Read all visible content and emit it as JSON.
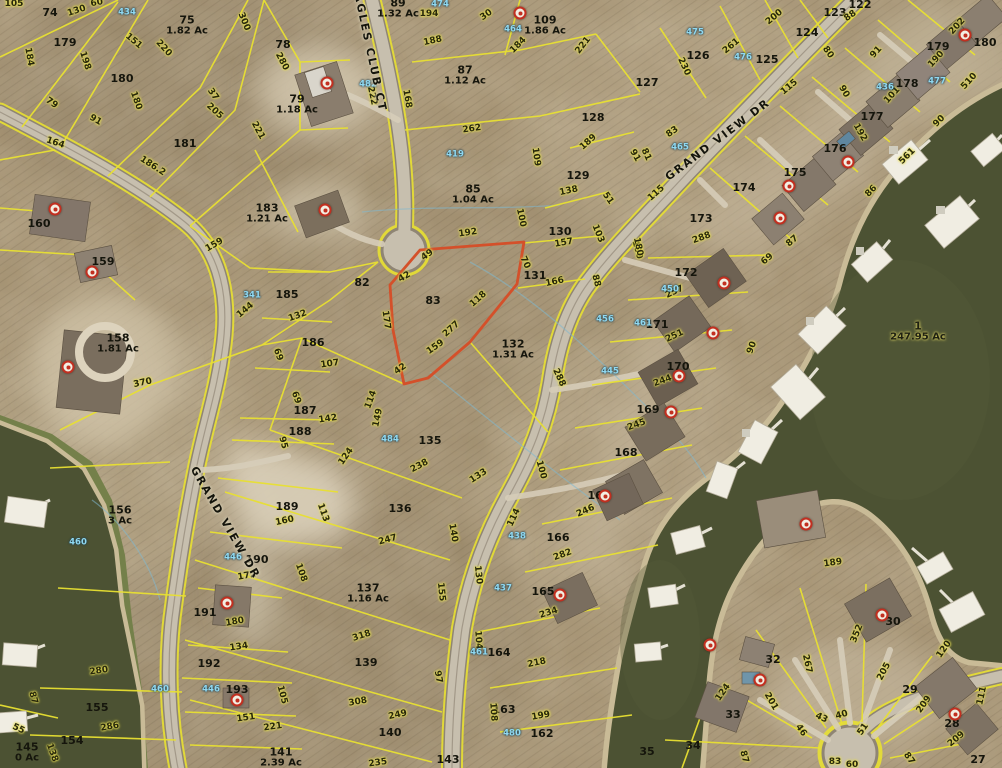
{
  "map": {
    "description": "aerial parcel map with lot boundaries and lake",
    "colors": {
      "parcel_line": "#e8e032",
      "highlight": "#d4502a",
      "water": "#4c5233",
      "blue_label": "#8fd9f2"
    },
    "streets": [
      {
        "name": "EAGLES CLUB CT",
        "x": 369,
        "y": 48,
        "rot": 78
      },
      {
        "name": "GRAND VIEW DR",
        "x": 718,
        "y": 140,
        "rot": -37
      },
      {
        "name": "GRAND VIEW DR",
        "x": 225,
        "y": 523,
        "rot": 60
      }
    ],
    "parcels": [
      {
        "id": "74",
        "x": 50,
        "y": 13
      },
      {
        "id": "179",
        "x": 65,
        "y": 43
      },
      {
        "id": "75",
        "ac": "1.82 Ac",
        "x": 187,
        "y": 26
      },
      {
        "id": "78",
        "x": 283,
        "y": 45
      },
      {
        "id": "180",
        "x": 122,
        "y": 79
      },
      {
        "id": "79",
        "ac": "1.18 Ac",
        "x": 297,
        "y": 105
      },
      {
        "id": "181",
        "x": 185,
        "y": 144
      },
      {
        "id": "160",
        "x": 39,
        "y": 224
      },
      {
        "id": "183",
        "ac": "1.21 Ac",
        "x": 267,
        "y": 214
      },
      {
        "id": "159",
        "x": 103,
        "y": 262
      },
      {
        "id": "158",
        "ac": "1.81 Ac",
        "x": 118,
        "y": 344
      },
      {
        "id": "185",
        "x": 287,
        "y": 295
      },
      {
        "id": "186",
        "x": 313,
        "y": 343
      },
      {
        "id": "187",
        "x": 305,
        "y": 411
      },
      {
        "id": "188",
        "x": 300,
        "y": 432
      },
      {
        "id": "156",
        "ac": "3 Ac",
        "x": 120,
        "y": 516
      },
      {
        "id": "189",
        "x": 287,
        "y": 507
      },
      {
        "id": "190",
        "x": 257,
        "y": 560
      },
      {
        "id": "191",
        "x": 205,
        "y": 613
      },
      {
        "id": "192",
        "x": 209,
        "y": 664
      },
      {
        "id": "193",
        "x": 237,
        "y": 690
      },
      {
        "id": "155",
        "x": 97,
        "y": 708
      },
      {
        "id": "154",
        "x": 72,
        "y": 741
      },
      {
        "id": "145",
        "ac": "0 Ac",
        "x": 27,
        "y": 753
      },
      {
        "id": "141",
        "ac": "2.39 Ac",
        "x": 281,
        "y": 758
      },
      {
        "id": "89",
        "ac": "1.32 Ac",
        "x": 398,
        "y": 9
      },
      {
        "id": "109",
        "ac": "1.86 Ac",
        "x": 545,
        "y": 26
      },
      {
        "id": "87",
        "ac": "1.12 Ac",
        "x": 465,
        "y": 76
      },
      {
        "id": "85",
        "ac": "1.04 Ac",
        "x": 473,
        "y": 195
      },
      {
        "id": "83",
        "x": 433,
        "y": 301
      },
      {
        "id": "82",
        "x": 362,
        "y": 283
      },
      {
        "id": "128",
        "x": 593,
        "y": 118
      },
      {
        "id": "129",
        "x": 578,
        "y": 176
      },
      {
        "id": "130",
        "x": 560,
        "y": 232
      },
      {
        "id": "131",
        "x": 535,
        "y": 276
      },
      {
        "id": "132",
        "ac": "1.31 Ac",
        "x": 513,
        "y": 350
      },
      {
        "id": "135",
        "x": 430,
        "y": 441
      },
      {
        "id": "136",
        "x": 400,
        "y": 509
      },
      {
        "id": "137",
        "ac": "1.16 Ac",
        "x": 368,
        "y": 594
      },
      {
        "id": "139",
        "x": 366,
        "y": 663
      },
      {
        "id": "140",
        "x": 390,
        "y": 733
      },
      {
        "id": "143",
        "x": 448,
        "y": 760
      },
      {
        "id": "164",
        "x": 499,
        "y": 653
      },
      {
        "id": "163",
        "x": 504,
        "y": 710
      },
      {
        "id": "162",
        "x": 542,
        "y": 734
      },
      {
        "id": "165",
        "x": 543,
        "y": 592
      },
      {
        "id": "166",
        "x": 558,
        "y": 538
      },
      {
        "id": "167",
        "x": 599,
        "y": 496
      },
      {
        "id": "168",
        "x": 626,
        "y": 453
      },
      {
        "id": "169",
        "x": 648,
        "y": 410
      },
      {
        "id": "170",
        "x": 678,
        "y": 367
      },
      {
        "id": "171",
        "x": 657,
        "y": 325
      },
      {
        "id": "172",
        "x": 686,
        "y": 273
      },
      {
        "id": "173",
        "x": 701,
        "y": 219
      },
      {
        "id": "174",
        "x": 744,
        "y": 188
      },
      {
        "id": "175",
        "x": 795,
        "y": 173
      },
      {
        "id": "176",
        "x": 835,
        "y": 149
      },
      {
        "id": "177",
        "x": 872,
        "y": 117
      },
      {
        "id": "178",
        "x": 907,
        "y": 84
      },
      {
        "id": "179",
        "x": 938,
        "y": 47
      },
      {
        "id": "180",
        "x": 985,
        "y": 43
      },
      {
        "id": "122",
        "x": 860,
        "y": 5
      },
      {
        "id": "123",
        "x": 835,
        "y": 13
      },
      {
        "id": "124",
        "x": 807,
        "y": 33
      },
      {
        "id": "125",
        "x": 767,
        "y": 60
      },
      {
        "id": "126",
        "x": 698,
        "y": 56
      },
      {
        "id": "127",
        "x": 647,
        "y": 83
      },
      {
        "id": "35",
        "x": 647,
        "y": 752
      },
      {
        "id": "34",
        "x": 693,
        "y": 746
      },
      {
        "id": "33",
        "x": 733,
        "y": 715
      },
      {
        "id": "32",
        "x": 773,
        "y": 660
      },
      {
        "id": "30",
        "x": 893,
        "y": 622
      },
      {
        "id": "29",
        "x": 910,
        "y": 690
      },
      {
        "id": "28",
        "x": 952,
        "y": 724
      },
      {
        "id": "27",
        "x": 978,
        "y": 760
      },
      {
        "id": "1",
        "ac": "247.95 Ac",
        "x": 918,
        "y": 332,
        "water": true
      }
    ],
    "dimensions": [
      [
        "105",
        14,
        5,
        0
      ],
      [
        "130",
        77,
        12,
        -18
      ],
      [
        "60",
        97,
        4,
        -10
      ],
      [
        "300",
        243,
        22,
        68
      ],
      [
        "220",
        163,
        49,
        47
      ],
      [
        "151",
        133,
        42,
        40
      ],
      [
        "184",
        28,
        57,
        80
      ],
      [
        "198",
        84,
        61,
        72
      ],
      [
        "79",
        51,
        104,
        35
      ],
      [
        "91",
        95,
        121,
        30
      ],
      [
        "164",
        55,
        144,
        18
      ],
      [
        "186.2",
        152,
        167,
        33
      ],
      [
        "180",
        135,
        101,
        70
      ],
      [
        "205",
        214,
        112,
        42
      ],
      [
        "221",
        257,
        131,
        62
      ],
      [
        "37",
        212,
        95,
        55
      ],
      [
        "280",
        281,
        62,
        62
      ],
      [
        "222",
        371,
        96,
        78
      ],
      [
        "168",
        406,
        99,
        80
      ],
      [
        "188",
        433,
        42,
        -12
      ],
      [
        "194",
        429,
        15,
        0
      ],
      [
        "30",
        487,
        16,
        -35
      ],
      [
        "184",
        519,
        46,
        -45
      ],
      [
        "221",
        584,
        46,
        -52
      ],
      [
        "262",
        472,
        130,
        -8
      ],
      [
        "109",
        535,
        157,
        82
      ],
      [
        "189",
        589,
        143,
        -42
      ],
      [
        "91",
        634,
        156,
        60
      ],
      [
        "115",
        657,
        194,
        -42
      ],
      [
        "138",
        569,
        192,
        -12
      ],
      [
        "51",
        607,
        199,
        55
      ],
      [
        "100",
        520,
        218,
        78
      ],
      [
        "103",
        597,
        234,
        68
      ],
      [
        "100",
        636,
        250,
        75
      ],
      [
        "157",
        564,
        244,
        -10
      ],
      [
        "70",
        524,
        263,
        65
      ],
      [
        "88",
        595,
        281,
        75
      ],
      [
        "166",
        555,
        283,
        -12
      ],
      [
        "192",
        468,
        234,
        -8
      ],
      [
        "49",
        428,
        256,
        -35
      ],
      [
        "42",
        405,
        278,
        -30
      ],
      [
        "42",
        401,
        370,
        -35
      ],
      [
        "177",
        385,
        320,
        82
      ],
      [
        "118",
        479,
        300,
        -42
      ],
      [
        "277",
        452,
        330,
        -42
      ],
      [
        "159",
        436,
        348,
        -35
      ],
      [
        "288",
        558,
        378,
        65
      ],
      [
        "159",
        215,
        246,
        -30
      ],
      [
        "144",
        246,
        311,
        -40
      ],
      [
        "132",
        298,
        317,
        -20
      ],
      [
        "370",
        143,
        384,
        -12
      ],
      [
        "69",
        277,
        355,
        70
      ],
      [
        "107",
        330,
        365,
        -8
      ],
      [
        "69",
        295,
        398,
        70
      ],
      [
        "142",
        328,
        420,
        -8
      ],
      [
        "114",
        372,
        400,
        -70
      ],
      [
        "149",
        379,
        418,
        -78
      ],
      [
        "95",
        282,
        443,
        75
      ],
      [
        "124",
        347,
        457,
        -55
      ],
      [
        "238",
        420,
        467,
        -28
      ],
      [
        "133",
        479,
        477,
        -33
      ],
      [
        "100",
        540,
        470,
        75
      ],
      [
        "247",
        388,
        541,
        -15
      ],
      [
        "140",
        452,
        533,
        80
      ],
      [
        "114",
        515,
        518,
        -65
      ],
      [
        "155",
        440,
        592,
        84
      ],
      [
        "130",
        477,
        575,
        84
      ],
      [
        "104",
        477,
        640,
        86
      ],
      [
        "97",
        437,
        677,
        80
      ],
      [
        "318",
        362,
        637,
        -18
      ],
      [
        "308",
        358,
        703,
        -10
      ],
      [
        "249",
        398,
        716,
        -12
      ],
      [
        "235",
        378,
        764,
        -8
      ],
      [
        "108",
        492,
        712,
        86
      ],
      [
        "218",
        537,
        664,
        -12
      ],
      [
        "199",
        541,
        717,
        -10
      ],
      [
        "234",
        549,
        614,
        -18
      ],
      [
        "282",
        563,
        556,
        -20
      ],
      [
        "246",
        586,
        512,
        -24
      ],
      [
        "245",
        637,
        426,
        -20
      ],
      [
        "244",
        663,
        382,
        -20
      ],
      [
        "251",
        675,
        337,
        -25
      ],
      [
        "257",
        675,
        293,
        -25
      ],
      [
        "288",
        702,
        239,
        -20
      ],
      [
        "180",
        637,
        247,
        78
      ],
      [
        "90",
        753,
        348,
        -70
      ],
      [
        "87",
        793,
        242,
        -40
      ],
      [
        "69",
        768,
        260,
        -40
      ],
      [
        "113",
        322,
        513,
        70
      ],
      [
        "160",
        285,
        522,
        -12
      ],
      [
        "172",
        247,
        577,
        -10
      ],
      [
        "108",
        300,
        573,
        70
      ],
      [
        "180",
        235,
        623,
        -10
      ],
      [
        "134",
        239,
        648,
        -8
      ],
      [
        "280",
        99,
        672,
        -8
      ],
      [
        "286",
        110,
        728,
        -10
      ],
      [
        "87",
        32,
        698,
        75
      ],
      [
        "138",
        51,
        753,
        70
      ],
      [
        "55",
        18,
        730,
        25
      ],
      [
        "151",
        246,
        719,
        -8
      ],
      [
        "221",
        273,
        728,
        -8
      ],
      [
        "105",
        281,
        695,
        75
      ],
      [
        "189",
        833,
        564,
        -8
      ],
      [
        "124",
        724,
        693,
        -55
      ],
      [
        "201",
        770,
        702,
        60
      ],
      [
        "267",
        806,
        664,
        78
      ],
      [
        "352",
        858,
        634,
        -68
      ],
      [
        "205",
        885,
        672,
        -62
      ],
      [
        "209",
        925,
        705,
        -55
      ],
      [
        "209",
        957,
        740,
        -40
      ],
      [
        "120",
        945,
        650,
        -55
      ],
      [
        "111",
        983,
        696,
        -78
      ],
      [
        "51",
        864,
        730,
        -55
      ],
      [
        "46",
        800,
        731,
        55
      ],
      [
        "43",
        821,
        719,
        25
      ],
      [
        "40",
        842,
        716,
        -15
      ],
      [
        "87",
        908,
        759,
        55
      ],
      [
        "87",
        743,
        757,
        75
      ],
      [
        "83",
        835,
        763,
        0
      ],
      [
        "60",
        852,
        766,
        0
      ],
      [
        "200",
        775,
        18,
        -40
      ],
      [
        "261",
        732,
        47,
        -40
      ],
      [
        "230",
        683,
        67,
        65
      ],
      [
        "115",
        790,
        88,
        -40
      ],
      [
        "81",
        645,
        155,
        65
      ],
      [
        "83",
        673,
        133,
        -35
      ],
      [
        "88",
        851,
        17,
        -35
      ],
      [
        "80",
        827,
        53,
        55
      ],
      [
        "90",
        843,
        92,
        60
      ],
      [
        "91",
        877,
        53,
        -48
      ],
      [
        "202",
        958,
        27,
        -48
      ],
      [
        "190",
        937,
        60,
        -48
      ],
      [
        "101",
        893,
        96,
        -48
      ],
      [
        "192",
        859,
        133,
        60
      ],
      [
        "86",
        872,
        192,
        -45
      ],
      [
        "561",
        908,
        157,
        -45
      ],
      [
        "510",
        970,
        82,
        -48
      ],
      [
        "90",
        940,
        122,
        -45
      ]
    ],
    "blue_labels": [
      [
        "474",
        440,
        5
      ],
      [
        "464",
        513,
        30
      ],
      [
        "482",
        368,
        85
      ],
      [
        "419",
        455,
        155
      ],
      [
        "434",
        127,
        13
      ],
      [
        "341",
        252,
        296
      ],
      [
        "475",
        695,
        33
      ],
      [
        "476",
        743,
        58
      ],
      [
        "477",
        937,
        82
      ],
      [
        "436",
        885,
        88
      ],
      [
        "465",
        680,
        148
      ],
      [
        "446",
        233,
        558
      ],
      [
        "446",
        211,
        690
      ],
      [
        "461",
        643,
        324
      ],
      [
        "450",
        670,
        290
      ],
      [
        "456",
        605,
        320
      ],
      [
        "438",
        517,
        537
      ],
      [
        "437",
        503,
        589
      ],
      [
        "484",
        390,
        440
      ],
      [
        "460",
        78,
        543
      ],
      [
        "460",
        160,
        690
      ],
      [
        "461",
        479,
        653
      ],
      [
        "480",
        512,
        734
      ],
      [
        "445",
        610,
        372
      ]
    ],
    "markers": [
      [
        520,
        13
      ],
      [
        327,
        83
      ],
      [
        325,
        210
      ],
      [
        55,
        209
      ],
      [
        92,
        272
      ],
      [
        68,
        367
      ],
      [
        227,
        603
      ],
      [
        237,
        700
      ],
      [
        560,
        595
      ],
      [
        605,
        496
      ],
      [
        671,
        412
      ],
      [
        679,
        376
      ],
      [
        713,
        333
      ],
      [
        724,
        283
      ],
      [
        789,
        186
      ],
      [
        848,
        162
      ],
      [
        780,
        218
      ],
      [
        965,
        35
      ],
      [
        882,
        615
      ],
      [
        955,
        714
      ],
      [
        806,
        524
      ],
      [
        760,
        680
      ],
      [
        710,
        645
      ]
    ]
  }
}
